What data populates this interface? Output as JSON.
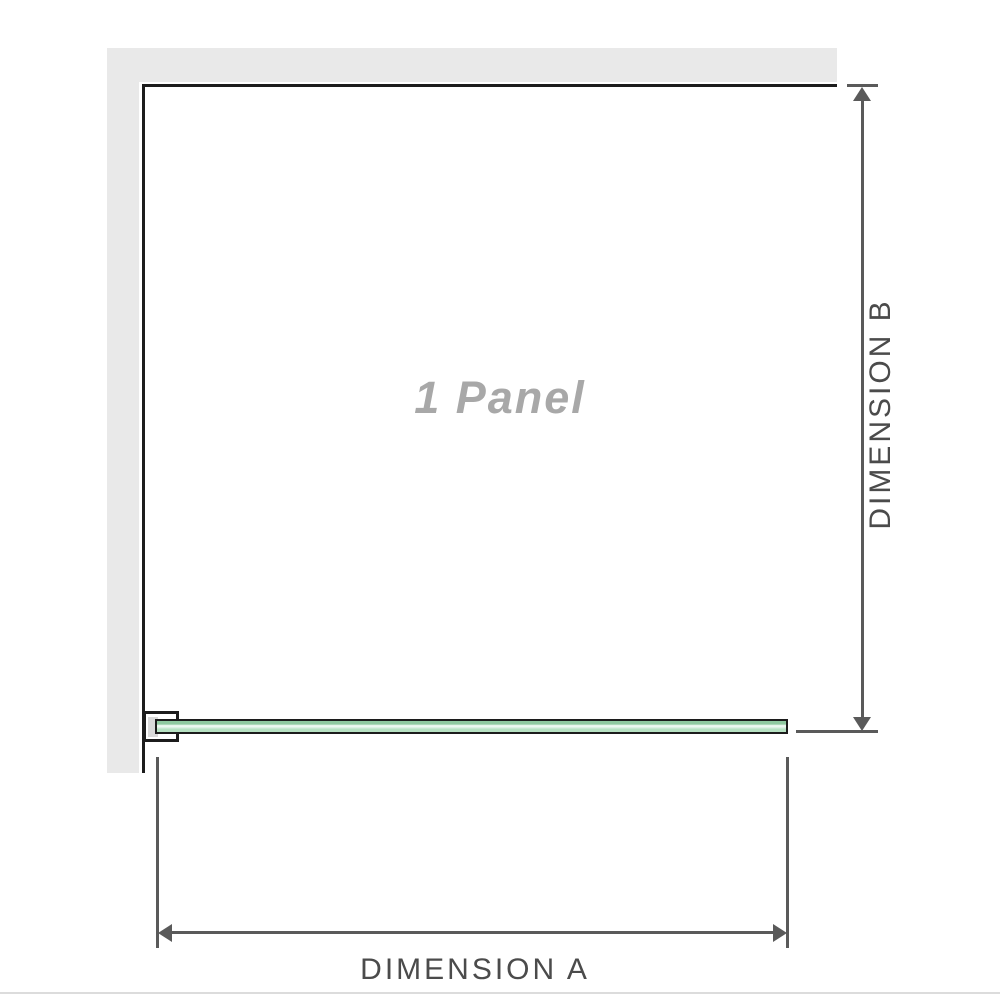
{
  "diagram": {
    "panel_label": "1 Panel",
    "dimension_a_label": "DIMENSION A",
    "dimension_b_label": "DIMENSION B",
    "colors": {
      "wall": "#e9e9e9",
      "outline": "#1c1c1c",
      "dimension": "#5a5a5a",
      "panel_text": "#a8a8a8",
      "label_text": "#4b4b4b",
      "glass_top": "#8fc9a0",
      "glass_light": "#edf8f1",
      "glass_base": "#b7e2c3",
      "bracket_fill": "#ffffff",
      "shim": "#d9d9d9",
      "divider": "#dcdcdc"
    }
  }
}
